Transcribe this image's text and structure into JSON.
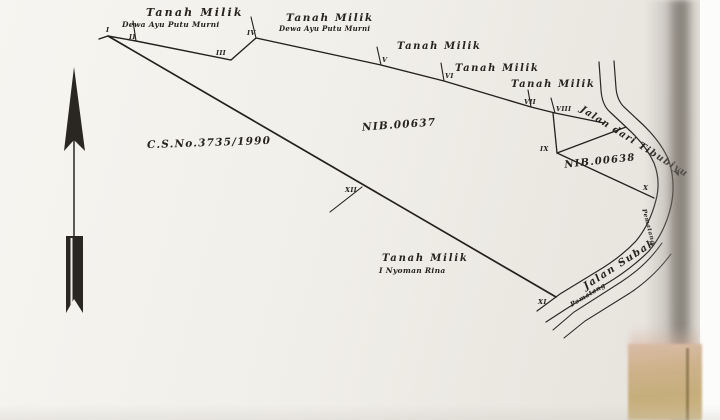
{
  "map": {
    "survey_number": "C.S.No.3735/1990",
    "parcel_main_nib": "NIB.00637",
    "parcel_secondary_nib": "NIB.00638",
    "owner_labels": {
      "north1_title": "Tanah Milik",
      "north1_name": "Dewa Ayu Putu Murni",
      "north2_title": "Tanah Milik",
      "north2_name": "Dewa Ayu Putu Murni",
      "north3_title": "Tanah Milik",
      "north4_title": "Tanah Milik",
      "north5_title": "Tanah Milik",
      "south_title": "Tanah Milik",
      "south_name": "I Nyoman Rina"
    },
    "roads": {
      "north_road": "Jalan dari Tibubiyu",
      "south_road": "Jalan Subak",
      "ridge_label_1": "Pematang",
      "ridge_label_2": "Pematang"
    },
    "boundary_markers": {
      "m1": "I",
      "m2": "II",
      "m3": "III",
      "m4": "IV",
      "m5": "V",
      "m6": "VI",
      "m7": "VII",
      "m8": "VIII",
      "m9": "IX",
      "m10": "X",
      "m11": "XI",
      "m12": "XII"
    }
  },
  "icons": {
    "north_arrow": "north-arrow",
    "road_direction_arrow": "➤"
  }
}
